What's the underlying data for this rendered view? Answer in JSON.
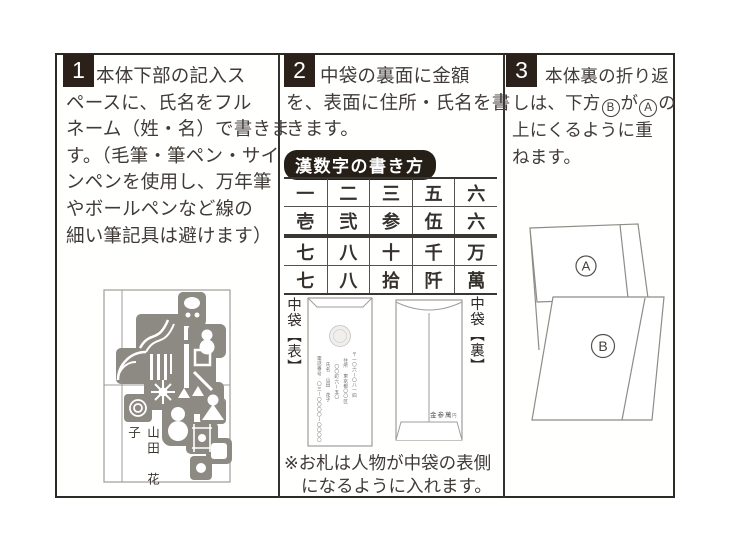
{
  "doc": {
    "colors": {
      "border": "#2d2925",
      "badge_bg": "#2b211a",
      "stamp_gray": "#8d8983",
      "line_gray": "#9f9c98",
      "text": "#403b37"
    }
  },
  "panels": {
    "p1": {
      "number": "1",
      "lines": [
        "本体下部の記入ス",
        "ペースに、氏名をフル",
        "ネーム（姓・名）で書きま",
        "す。（毛筆・筆ペン・サイ",
        "ンペンを使用し、万年筆",
        "やボールペンなど線の",
        "細い筆記具は避けます）"
      ],
      "envelope_name": "山田　花子"
    },
    "p2": {
      "number": "2",
      "lines": [
        "中袋の裏面に金額",
        "を、表面に住所・氏名を書",
        "きます。"
      ],
      "table_title": "漢数字の書き方",
      "table_rows": [
        [
          "一",
          "二",
          "三",
          "五",
          "六"
        ],
        [
          "壱",
          "弐",
          "参",
          "伍",
          "六"
        ],
        [
          "七",
          "八",
          "十",
          "千",
          "万"
        ],
        [
          "七",
          "八",
          "拾",
          "阡",
          "萬"
        ]
      ],
      "front_label": "中袋【表】",
      "back_label": "中袋【裏】",
      "front_lines": {
        "postal": "〒一〇六ー〇八一四",
        "addr1": "住所　東京都〇〇区",
        "addr2": "〇〇町六ー五〇",
        "name": "氏名　山田　花子",
        "tel": "電話番号　〇三ー〇〇〇〇ー〇〇〇〇"
      },
      "amount": "金参萬",
      "amount_unit": "円",
      "note_line1": "※お札は人物が中袋の表側",
      "note_line2": "になるように入れます。"
    },
    "p3": {
      "number": "3",
      "line1": "本体裏の折り返",
      "line2_a": "しは、下方",
      "circle_b": "B",
      "line2_b": "が",
      "circle_a": "A",
      "line2_c": "の",
      "line3": "上にくるように重",
      "line4": "ねます。",
      "flap_a_label": "A",
      "flap_b_label": "B"
    }
  }
}
